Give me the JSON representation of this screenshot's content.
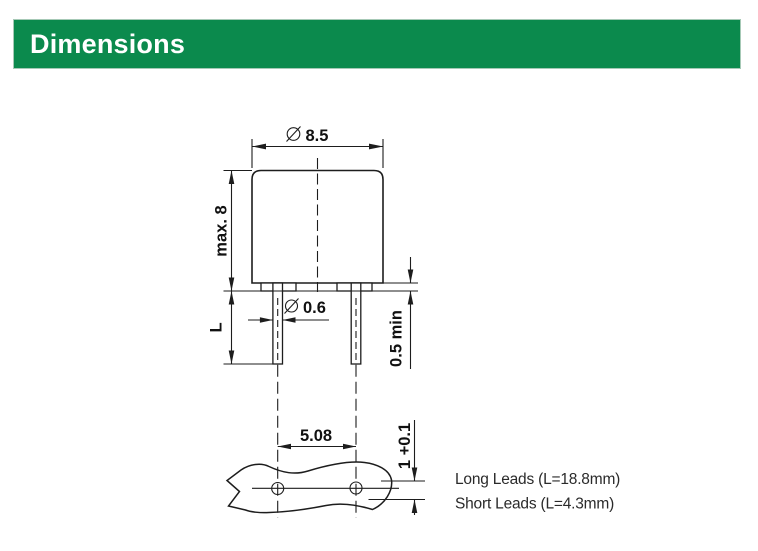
{
  "header": {
    "title": "Dimensions",
    "bg_color": "#0B8A4D",
    "text_color": "#FFFFFF"
  },
  "drawing": {
    "line_color": "#1D1D1D",
    "diameter_symbol": "∅",
    "dims": {
      "body_diameter": "8.5",
      "body_height": "max. 8",
      "lead_length": "L",
      "lead_diameter": "0.6",
      "standoff_min": "0.5 min",
      "lead_spacing": "5.08",
      "pcb_thickness": "1 +0.1"
    },
    "notes": {
      "long_leads": "Long Leads (L=18.8mm)",
      "short_leads": "Short Leads (L=4.3mm)"
    }
  }
}
